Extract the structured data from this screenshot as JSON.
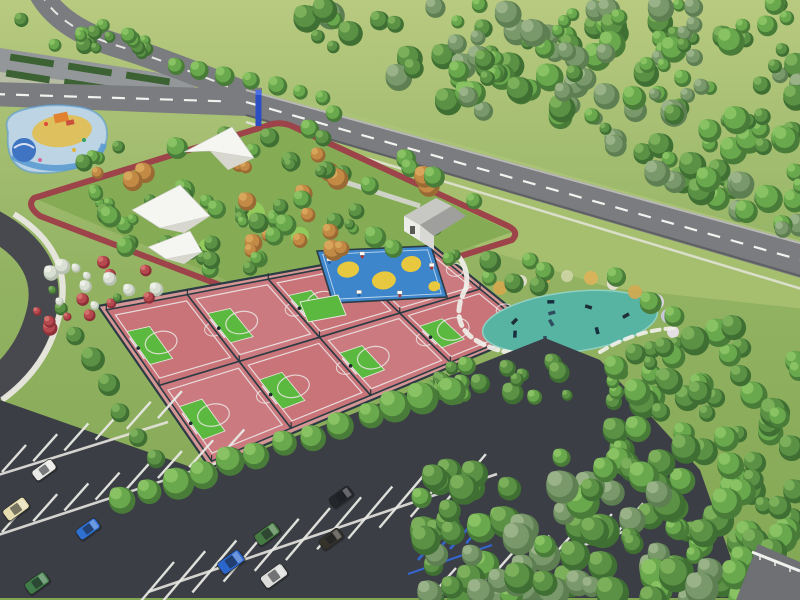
{
  "palette": {
    "grass_top": "#b8ca80",
    "grass_bottom": "#82a753",
    "lawn_park": "#85ac55",
    "field_light": "#a5bf6e",
    "field_upper": "#aac377",
    "road_gray": "#7a7c7f",
    "road_edge_light": "#b9b9b5",
    "road_edge_dark": "#5e6063",
    "road_dark": "#47494e",
    "parking_asphalt": "#3b3f45",
    "line_white": "#f2f2ee",
    "sidewalk": "#e9e7e1",
    "stripe_white": "#e9e9e4",
    "track_red": "#9c4449",
    "court_apron": "#d49694",
    "court_pink": "#c87479",
    "court_pink_alt": "#cb7a7f",
    "key_green": "#5bb93f",
    "court_line": "#ece6e4",
    "fence_dark": "#2c3b44",
    "kids_blue": "#3d86cb",
    "kids_yellow": "#e7c83e",
    "teal_surface": "#57b3a2",
    "teal_edge": "#8fd0c2",
    "water_blue": "#3f74c2",
    "splash_ring": "#5b9bd0",
    "splash_base": "#bcd4e4",
    "sand_yellow": "#dfc05e",
    "slide_orange": "#e0822f",
    "sail_white": "#f5f5f1",
    "sail_shadow": "#d7d7cf",
    "roof_light": "#c7c7c4",
    "roof_dark": "#9fa09e",
    "wall_white": "#ecece8",
    "wall_shade": "#d8d8d4",
    "sign_blue": "#2b4ec5",
    "accessible_blue": "#3565cf",
    "equip_dark": "#1f2e35",
    "mound_green": "#93cd5d",
    "path_white": "#f0efe9",
    "hedge_green": "#3c6233",
    "nw_lot_gray": "#94979a",
    "concrete_band": "#b9bab6",
    "corner_road": "#6e7073",
    "rail_white": "#f0f0ec"
  },
  "scene": {
    "tree_ramps": [
      [
        "#3f6f33",
        "#5b9145",
        "#7fb35c"
      ],
      [
        "#5e7f52",
        "#7a996b",
        "#9db58b"
      ],
      [
        "#497c38",
        "#69a84c",
        "#8cc465"
      ],
      [
        "#9a6a35",
        "#c28a45",
        "#d9a85c"
      ],
      [
        "#8e3038",
        "#b5494f",
        "#d4766f"
      ],
      [
        "#b9c2b2",
        "#d9dfd2",
        "#eef2e8"
      ]
    ],
    "forest_zones": [
      {
        "name": "north-forest",
        "poly": [
          [
            280,
            0
          ],
          [
            800,
            0
          ],
          [
            800,
            238
          ],
          [
            640,
            168
          ],
          [
            460,
            108
          ],
          [
            320,
            42
          ]
        ],
        "count": 170,
        "rmin": 6,
        "rmax": 14,
        "ramps": [
          1,
          2,
          0
        ]
      },
      {
        "name": "playground-grove",
        "poly": [
          [
            72,
            152
          ],
          [
            330,
            108
          ],
          [
            478,
            202
          ],
          [
            300,
            298
          ],
          [
            84,
            236
          ]
        ],
        "count": 85,
        "rmin": 5,
        "rmax": 11,
        "ramps": [
          0,
          2,
          2,
          3
        ]
      },
      {
        "name": "northwest-corner-trees",
        "poly": [
          [
            0,
            14
          ],
          [
            122,
            26
          ],
          [
            168,
            54
          ],
          [
            28,
            44
          ]
        ],
        "count": 20,
        "rmin": 5,
        "rmax": 9,
        "ramps": [
          0,
          2
        ]
      },
      {
        "name": "pond-grove",
        "poly": [
          [
            432,
            238
          ],
          [
            600,
            262
          ],
          [
            690,
            326
          ],
          [
            652,
            412
          ],
          [
            540,
            406
          ],
          [
            432,
            376
          ]
        ],
        "count": 34,
        "rmin": 5,
        "rmax": 11,
        "ramps": [
          0,
          2
        ]
      },
      {
        "name": "court-east-trees",
        "poly": [
          [
            420,
            318
          ],
          [
            478,
            338
          ],
          [
            468,
            408
          ],
          [
            420,
            398
          ]
        ],
        "count": 12,
        "rmin": 6,
        "rmax": 10,
        "ramps": [
          0,
          2
        ]
      },
      {
        "name": "flower-shrubs",
        "poly": [
          [
            16,
            246
          ],
          [
            148,
            262
          ],
          [
            168,
            320
          ],
          [
            42,
            330
          ]
        ],
        "count": 24,
        "rmin": 4,
        "rmax": 8,
        "ramps": [
          4,
          5,
          0,
          4
        ]
      },
      {
        "name": "east-forest",
        "poly": [
          [
            612,
            290
          ],
          [
            800,
            336
          ],
          [
            800,
            598
          ],
          [
            690,
            598
          ],
          [
            596,
            420
          ]
        ],
        "count": 80,
        "rmin": 8,
        "rmax": 16,
        "ramps": [
          0,
          2
        ]
      },
      {
        "name": "south-forest",
        "poly": [
          [
            418,
            468
          ],
          [
            540,
            412
          ],
          [
            665,
            478
          ],
          [
            758,
            598
          ],
          [
            425,
            598
          ]
        ],
        "count": 90,
        "rmin": 9,
        "rmax": 17,
        "ramps": [
          0,
          2,
          1
        ]
      }
    ],
    "tree_rows": [
      {
        "name": "parking-tree-row",
        "from": [
          120,
          497
        ],
        "to": [
          448,
          388
        ],
        "count": 13,
        "rmin": 12,
        "rmax": 16,
        "ramp": 2
      },
      {
        "name": "court-west-trees",
        "from": [
          74,
          334
        ],
        "to": [
          152,
          460
        ],
        "count": 6,
        "rmin": 9,
        "rmax": 12,
        "ramp": 0
      },
      {
        "name": "road-median-trees",
        "from": [
          176,
          62
        ],
        "to": [
          322,
          98
        ],
        "count": 7,
        "rmin": 7,
        "rmax": 10,
        "ramp": 2
      }
    ],
    "courts": {
      "quad": [
        [
          98,
          306
        ],
        [
          432,
          245
        ],
        [
          538,
          330
        ],
        [
          210,
          468
        ]
      ],
      "cols": 4,
      "rows": 2
    },
    "kids_court": {
      "quad": [
        [
          317,
          251
        ],
        [
          431,
          246
        ],
        [
          447,
          297
        ],
        [
          333,
          303
        ]
      ],
      "yellow_spots": [
        [
          0.22,
          0.38,
          11,
          8
        ],
        [
          0.5,
          0.62,
          12,
          9
        ],
        [
          0.78,
          0.33,
          10,
          8
        ],
        [
          0.92,
          0.78,
          6,
          5
        ]
      ],
      "backboards": [
        [
          0.08,
          0.2
        ],
        [
          0.38,
          0.12
        ],
        [
          0.68,
          0.1
        ],
        [
          0.95,
          0.4
        ],
        [
          0.25,
          0.85
        ],
        [
          0.6,
          0.9
        ]
      ]
    },
    "mini_court": {
      "pts": "300,302 338,295 346,315 308,322"
    },
    "fitness_pads": [
      {
        "cx": 570,
        "cy": 322,
        "rx": 88,
        "ry": 30,
        "rot": -7,
        "equip": 9
      },
      {
        "cx": 488,
        "cy": 432,
        "rx": 78,
        "ry": 34,
        "rot": -5,
        "equip": 14
      }
    ],
    "accent_bushes": [
      [
        500,
        288,
        7,
        "#d2a94e"
      ],
      [
        521,
        281,
        6,
        "#e3ddcf"
      ],
      [
        544,
        277,
        7,
        "#d2a94e"
      ],
      [
        567,
        276,
        6,
        "#cbd3a2"
      ],
      [
        591,
        278,
        7,
        "#d9b35a"
      ],
      [
        613,
        284,
        6,
        "#e6e0d6"
      ],
      [
        635,
        292,
        7,
        "#d0aa52"
      ],
      [
        656,
        302,
        8,
        "#ded7e6"
      ],
      [
        668,
        316,
        7,
        "#cfc8e0"
      ],
      [
        673,
        332,
        6,
        "#e8e2ea"
      ],
      [
        420,
        392,
        6,
        "#d2a94e"
      ],
      [
        405,
        408,
        5,
        "#e3ddcf"
      ],
      [
        562,
        414,
        6,
        "#d8b258"
      ],
      [
        447,
        390,
        5,
        "#cbd3a2"
      ]
    ],
    "mounds": [
      [
        252,
        214,
        13
      ],
      [
        300,
        236,
        9
      ],
      [
        206,
        246,
        7
      ],
      [
        336,
        262,
        8
      ]
    ],
    "sails": [
      {
        "main": "184,152 232,127 254,158 210,151",
        "facet": "210,151 254,158 228,170"
      },
      {
        "main": "132,210 180,185 210,216 160,228",
        "facet": "160,228 210,216 184,233"
      },
      {
        "main": "148,247 190,231 202,252 166,259",
        "facet": "166,259 202,252 184,264"
      }
    ],
    "paths": [
      {
        "d": "M 455,252 Q 470,268 466,288",
        "dash": "",
        "w": 5
      },
      {
        "d": "M 466,288 Q 450,318 470,336 Q 492,354 540,356",
        "dash": "9 6",
        "w": 5
      },
      {
        "d": "M 540,356 Q 592,360 612,382 Q 624,398 602,412",
        "dash": "9 6",
        "w": 5
      },
      {
        "d": "M 600,352 Q 636,330 676,328",
        "dash": "8 6",
        "w": 4
      },
      {
        "d": "M 412,452 Q 440,478 502,474",
        "dash": "9 6",
        "w": 5
      },
      {
        "d": "M 392,434 Q 418,420 446,414",
        "dash": "8 6",
        "w": 4
      }
    ],
    "parking": {
      "asphalt_pts": "0,400 205,472 545,338 600,360 700,470 745,598 0,598",
      "aisles": [
        [
          -5,
          476,
          168,
          422
        ],
        [
          -5,
          536,
          232,
          458
        ],
        [
          148,
          592,
          497,
          474
        ],
        [
          428,
          598,
          664,
          518
        ]
      ],
      "stripe_rows": [
        {
          "start": [
            2,
            472
          ],
          "count": 6,
          "gap": 33,
          "dir": [
            0.945,
            -0.327
          ],
          "vec": [
            24,
            -27
          ]
        },
        {
          "start": [
            2,
            532
          ],
          "count": 8,
          "gap": 33,
          "dir": [
            0.945,
            -0.327
          ],
          "vec": [
            24,
            -27
          ]
        },
        {
          "start": [
            152,
            588
          ],
          "count": 11,
          "gap": 33,
          "dir": [
            0.945,
            -0.327
          ],
          "vec": [
            22,
            -26
          ]
        },
        {
          "start": [
            152,
            588
          ],
          "count": 11,
          "gap": 33,
          "dir": [
            0.945,
            -0.327
          ],
          "vec": [
            -22,
            26
          ]
        },
        {
          "start": [
            432,
            595
          ],
          "count": 7,
          "gap": 33,
          "dir": [
            0.945,
            -0.327
          ],
          "vec": [
            24,
            -27
          ]
        }
      ],
      "accessible": {
        "start": [
          418,
          560
        ],
        "count": 5,
        "gap": 17,
        "vec": [
          20,
          -23
        ],
        "aisle": [
          408,
          574,
          492,
          545
        ]
      }
    },
    "cars": [
      {
        "name": "white-car",
        "color": "#e8e8e6",
        "x": 44,
        "y": 470,
        "angle": -36,
        "w": 24,
        "h": 12
      },
      {
        "name": "cream-van",
        "color": "#e6ddb0",
        "x": 16,
        "y": 509,
        "angle": -36,
        "w": 26,
        "h": 13
      },
      {
        "name": "blue-car",
        "color": "#2f6fd0",
        "x": 88,
        "y": 529,
        "angle": -36,
        "w": 24,
        "h": 12
      },
      {
        "name": "green-car",
        "color": "#3f7c49",
        "x": 37,
        "y": 583,
        "angle": -36,
        "w": 24,
        "h": 13
      },
      {
        "name": "green-suv",
        "color": "#457a43",
        "x": 267,
        "y": 534,
        "angle": -36,
        "w": 25,
        "h": 13
      },
      {
        "name": "blue-van",
        "color": "#2b66cc",
        "x": 231,
        "y": 562,
        "angle": -36,
        "w": 26,
        "h": 14
      },
      {
        "name": "white-van",
        "color": "#dcdcda",
        "x": 274,
        "y": 576,
        "angle": -36,
        "w": 26,
        "h": 14
      },
      {
        "name": "black-car",
        "color": "#23262b",
        "x": 341,
        "y": 497,
        "angle": -36,
        "w": 24,
        "h": 12
      },
      {
        "name": "dark-car",
        "color": "#35322c",
        "x": 331,
        "y": 539,
        "angle": -36,
        "w": 24,
        "h": 12
      }
    ],
    "hedges": [
      [
        10,
        57
      ],
      [
        68,
        66
      ],
      [
        126,
        75
      ],
      [
        6,
        73
      ],
      [
        64,
        82
      ],
      [
        122,
        91
      ]
    ]
  }
}
